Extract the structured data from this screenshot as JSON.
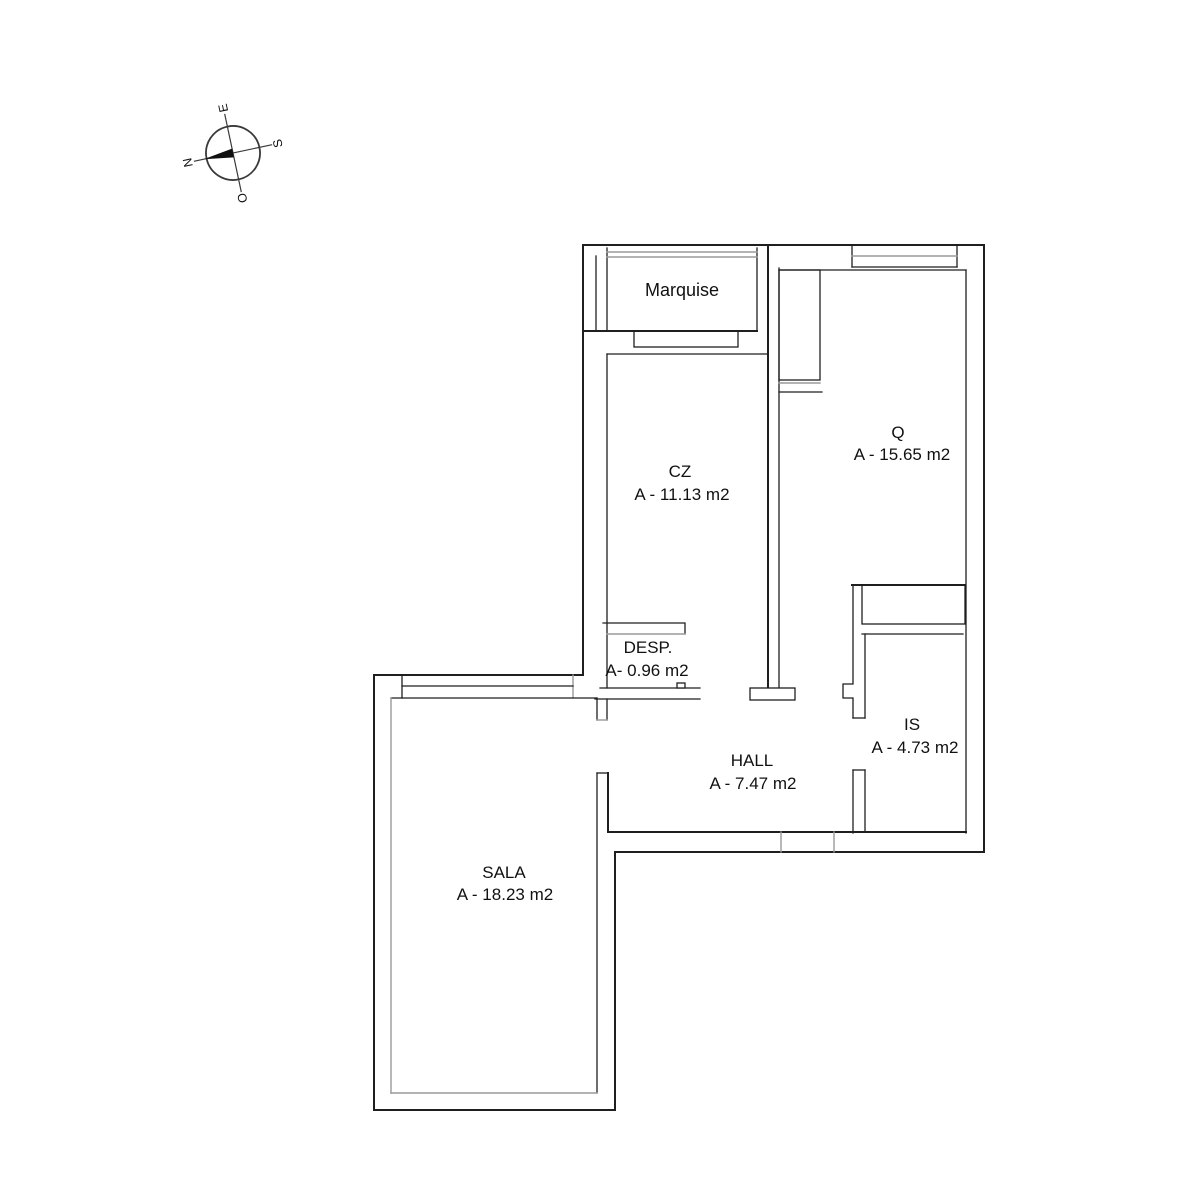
{
  "title": "Apartment floor plan",
  "compass": {
    "north": "N",
    "east": "E",
    "south": "S",
    "west": "O"
  },
  "rooms": [
    {
      "id": "marquise",
      "label": "Marquise",
      "area": ""
    },
    {
      "id": "cz",
      "label": "CZ",
      "area": "A - 11.13 m2"
    },
    {
      "id": "q",
      "label": "Q",
      "area": "A - 15.65 m2"
    },
    {
      "id": "desp",
      "label": "DESP.",
      "area": "A- 0.96 m2"
    },
    {
      "id": "is",
      "label": "IS",
      "area": "A - 4.73 m2"
    },
    {
      "id": "hall",
      "label": "HALL",
      "area": "A - 7.47 m2"
    },
    {
      "id": "sala",
      "label": "SALA",
      "area": "A - 18.23 m2"
    }
  ],
  "colors": {
    "wall": "#1f1f1f",
    "fixture": "#9a9a9a",
    "text": "#111111",
    "background": "#ffffff"
  }
}
